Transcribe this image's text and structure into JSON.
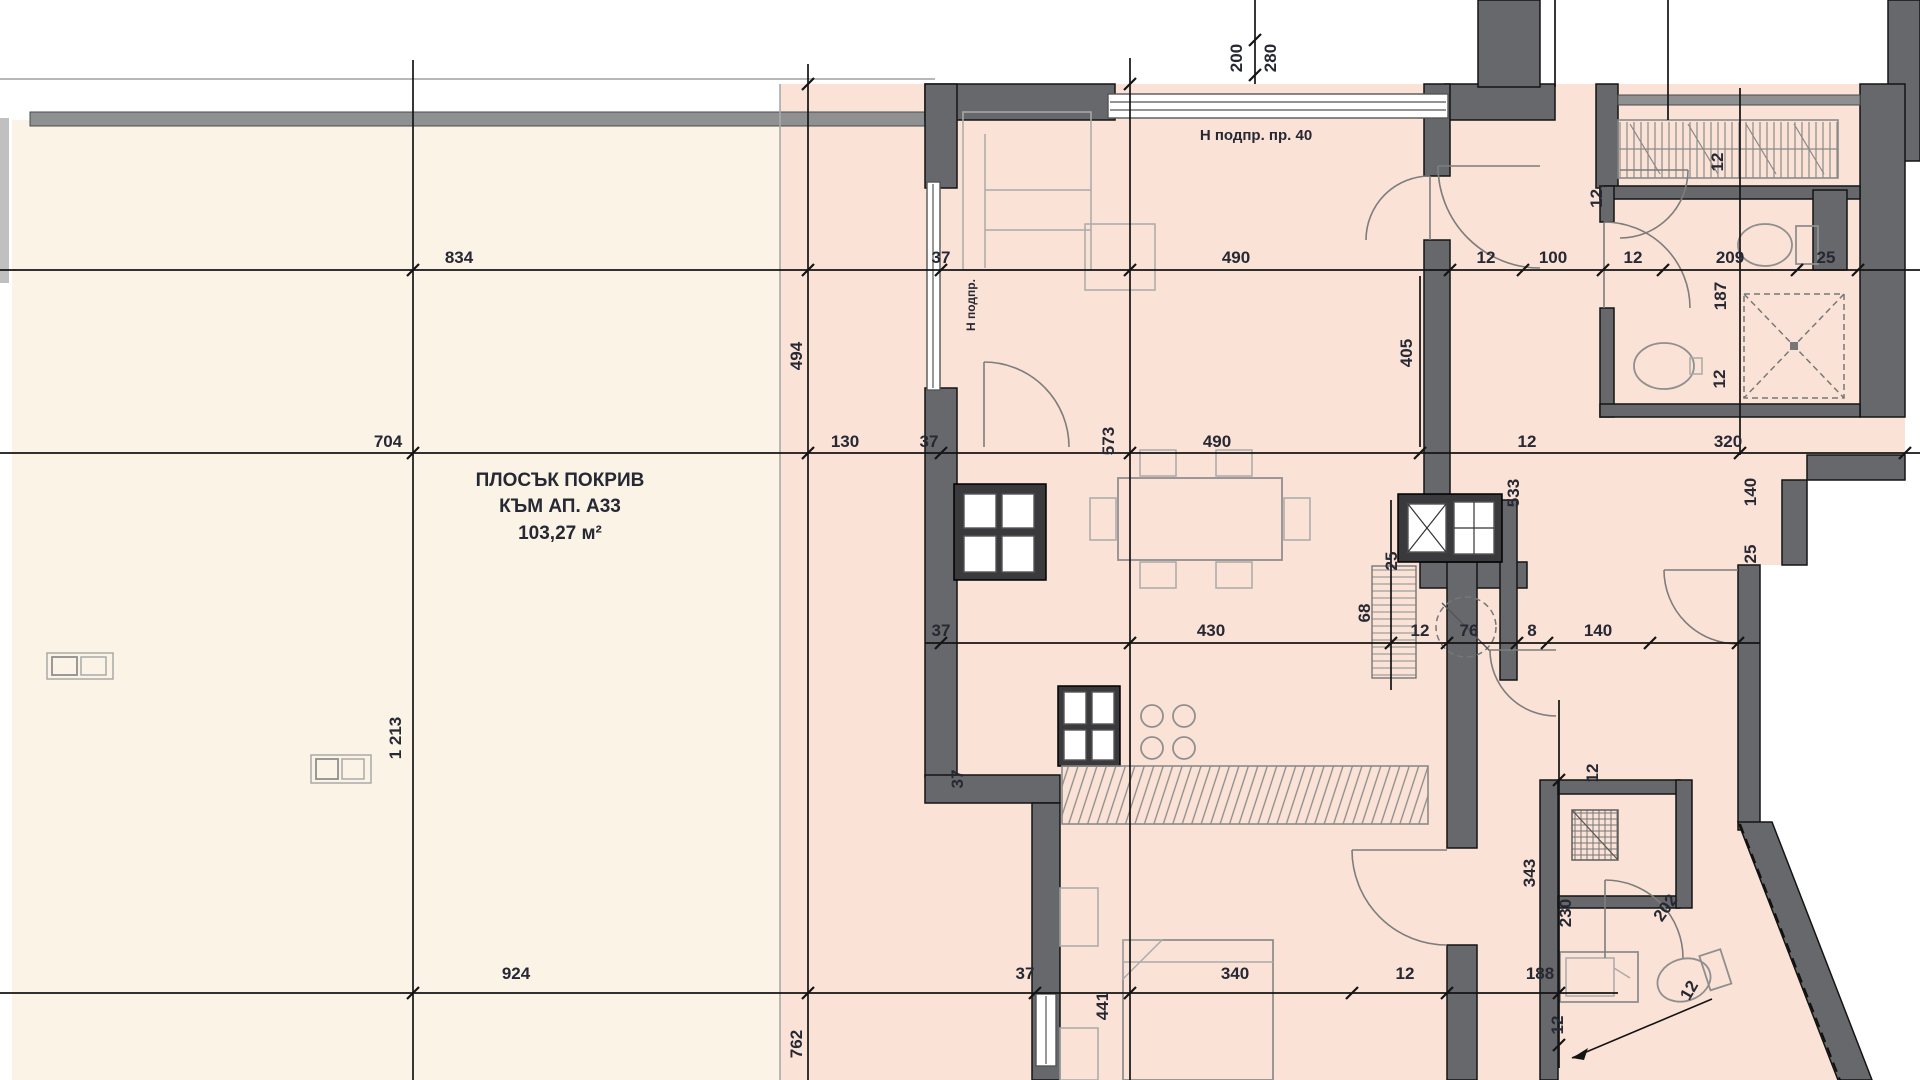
{
  "plan": {
    "roof_label": {
      "line1": "ПЛОСЪК ПОКРИВ",
      "line2": "КЪМ АП. А33",
      "area": "103,27 м²"
    },
    "note_top": "Н подпр. пр. 40",
    "wall_note": "Н подпр."
  },
  "colors": {
    "roof_fill": "#FAF3E6",
    "floor_fill": "#FBE2D6",
    "wall": "#66686B",
    "wall_dark": "#3A3A3C",
    "parapet": "#8F9092",
    "line": "#141414",
    "light_line": "#B8B8B8",
    "fixture": "#8F8F8F",
    "text": "#262833"
  },
  "dimension_labels": [
    {
      "t": "834",
      "x": 459,
      "y": 263
    },
    {
      "t": "37",
      "x": 941,
      "y": 263
    },
    {
      "t": "490",
      "x": 1236,
      "y": 263
    },
    {
      "t": "12",
      "x": 1486,
      "y": 263
    },
    {
      "t": "100",
      "x": 1553,
      "y": 263
    },
    {
      "t": "12",
      "x": 1633,
      "y": 263
    },
    {
      "t": "209",
      "x": 1730,
      "y": 263
    },
    {
      "t": "25",
      "x": 1826,
      "y": 263
    },
    {
      "t": "187",
      "x": 1726,
      "y": 296,
      "r": -90
    },
    {
      "t": "200",
      "x": 1242,
      "y": 58,
      "r": -90
    },
    {
      "t": "280",
      "x": 1276,
      "y": 58,
      "r": -90
    },
    {
      "t": "12",
      "x": 1723,
      "y": 162,
      "r": -90
    },
    {
      "t": "12,",
      "x": 1602,
      "y": 196,
      "r": -90
    },
    {
      "t": "12",
      "x": 1725,
      "y": 379,
      "r": -90
    },
    {
      "t": "405",
      "x": 1412,
      "y": 353,
      "r": -90
    },
    {
      "t": "704",
      "x": 388,
      "y": 447
    },
    {
      "t": "130",
      "x": 845,
      "y": 447
    },
    {
      "t": "37",
      "x": 929,
      "y": 447
    },
    {
      "t": "490",
      "x": 1217,
      "y": 447
    },
    {
      "t": "12",
      "x": 1527,
      "y": 447
    },
    {
      "t": "320",
      "x": 1728,
      "y": 447
    },
    {
      "t": "494",
      "x": 802,
      "y": 356,
      "r": -90
    },
    {
      "t": "573",
      "x": 1114,
      "y": 441,
      "r": -90
    },
    {
      "t": "533",
      "x": 1519,
      "y": 493,
      "r": -90
    },
    {
      "t": "140",
      "x": 1756,
      "y": 492,
      "r": -90
    },
    {
      "t": "25",
      "x": 1756,
      "y": 554,
      "r": -90
    },
    {
      "t": "1 213",
      "x": 401,
      "y": 738,
      "r": -90
    },
    {
      "t": "37",
      "x": 941,
      "y": 636
    },
    {
      "t": "430",
      "x": 1211,
      "y": 636
    },
    {
      "t": "12",
      "x": 1420,
      "y": 636
    },
    {
      "t": "76",
      "x": 1469,
      "y": 636
    },
    {
      "t": "8",
      "x": 1532,
      "y": 636
    },
    {
      "t": "140",
      "x": 1598,
      "y": 636
    },
    {
      "t": "68",
      "x": 1370,
      "y": 613,
      "r": -90
    },
    {
      "t": "25",
      "x": 1397,
      "y": 561,
      "r": -90
    },
    {
      "t": "37",
      "x": 963,
      "y": 779,
      "r": -90
    },
    {
      "t": "12",
      "x": 1598,
      "y": 773,
      "r": -90
    },
    {
      "t": "343",
      "x": 1535,
      "y": 873,
      "r": -90
    },
    {
      "t": "230",
      "x": 1571,
      "y": 913,
      "r": -90
    },
    {
      "t": "202",
      "x": 1670,
      "y": 911,
      "r": -55
    },
    {
      "t": "924",
      "x": 516,
      "y": 979
    },
    {
      "t": "37",
      "x": 1025,
      "y": 979
    },
    {
      "t": "340",
      "x": 1235,
      "y": 979
    },
    {
      "t": "12",
      "x": 1405,
      "y": 979
    },
    {
      "t": "188",
      "x": 1540,
      "y": 979
    },
    {
      "t": "441",
      "x": 1108,
      "y": 1006,
      "r": -90
    },
    {
      "t": "762",
      "x": 802,
      "y": 1044,
      "r": -90
    },
    {
      "t": "12",
      "x": 1563,
      "y": 1025,
      "r": -90
    },
    {
      "t": "12",
      "x": 1694,
      "y": 993,
      "r": -60
    }
  ]
}
